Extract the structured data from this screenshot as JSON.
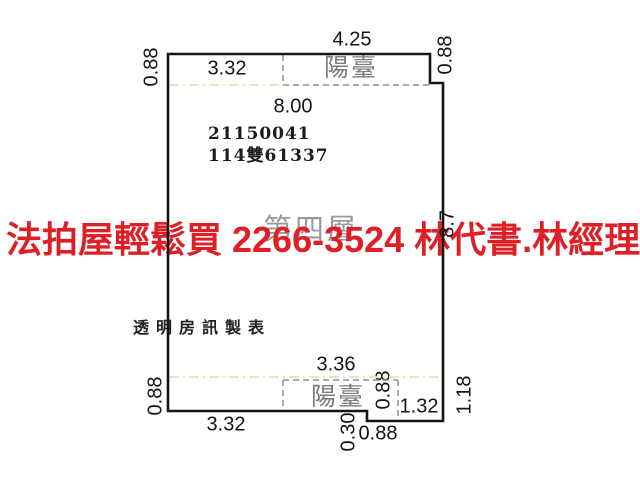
{
  "floor_plan": {
    "floor_label": "第四層",
    "balcony_top_label": "陽臺",
    "balcony_bottom_label": "陽臺",
    "parcel_number": "21150041",
    "registration_number": "114雙61337",
    "maker_label": "透明房訊製表",
    "dimensions": {
      "top_width": "4.25",
      "top_side_left": "0.88",
      "top_side_right": "0.88",
      "top_inner_width": "3.32",
      "interior_width": "8.00",
      "right_height": "8.7",
      "bottom_balcony_width": "3.36",
      "bottom_side_left": "0.88",
      "bottom_width": "3.32",
      "balcony_side": "0.88",
      "step_height": "0.30",
      "step_width": "0.88",
      "bottom_right_width": "1.32",
      "bottom_side_right": "1.18"
    }
  },
  "watermark": {
    "text": "法拍屋輕鬆買  2266-3524  林代書.林經理",
    "color": "#de1f26"
  },
  "colors": {
    "wall": "#151515",
    "dashed_line": "#8f8f8f",
    "guide_line": "#e7e7bd",
    "gray_text": "#7b7b7b"
  }
}
